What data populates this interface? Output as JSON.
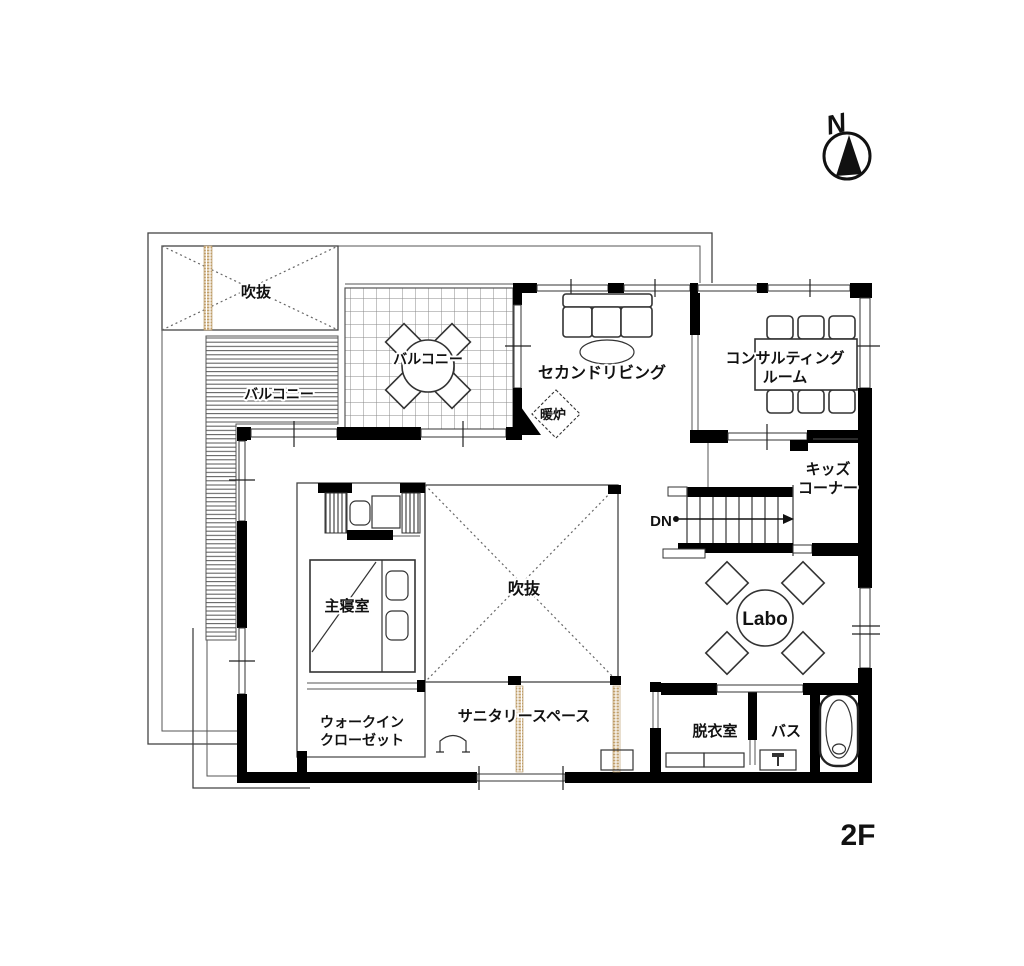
{
  "page": {
    "floor_label": "2F"
  },
  "compass": {
    "label": "N"
  },
  "rooms": {
    "void_top": {
      "label": "吹抜"
    },
    "balcony_left": {
      "label": "バルコニー"
    },
    "balcony_top": {
      "label": "バルコニー"
    },
    "second_living": {
      "label": "セカンドリビング"
    },
    "fireplace": {
      "label": "暖炉"
    },
    "consulting": {
      "label_line1": "コンサルティング",
      "label_line2": "ルーム"
    },
    "kids_corner": {
      "label_line1": "キッズ",
      "label_line2": "コーナー"
    },
    "stairs": {
      "label": "DN"
    },
    "master_bedroom": {
      "label": "主寝室"
    },
    "void_center": {
      "label": "吹抜"
    },
    "labo": {
      "label": "Labo"
    },
    "walk_in_closet": {
      "label_line1": "ウォークイン",
      "label_line2": "クローゼット"
    },
    "sanitary": {
      "label": "サニタリースペース"
    },
    "dressing": {
      "label": "脱衣室"
    },
    "bath": {
      "label": "バス"
    }
  },
  "colors": {
    "wall": "#000000",
    "thin_line": "#555555",
    "accent_tan": "#c2a06b",
    "background": "#ffffff"
  }
}
